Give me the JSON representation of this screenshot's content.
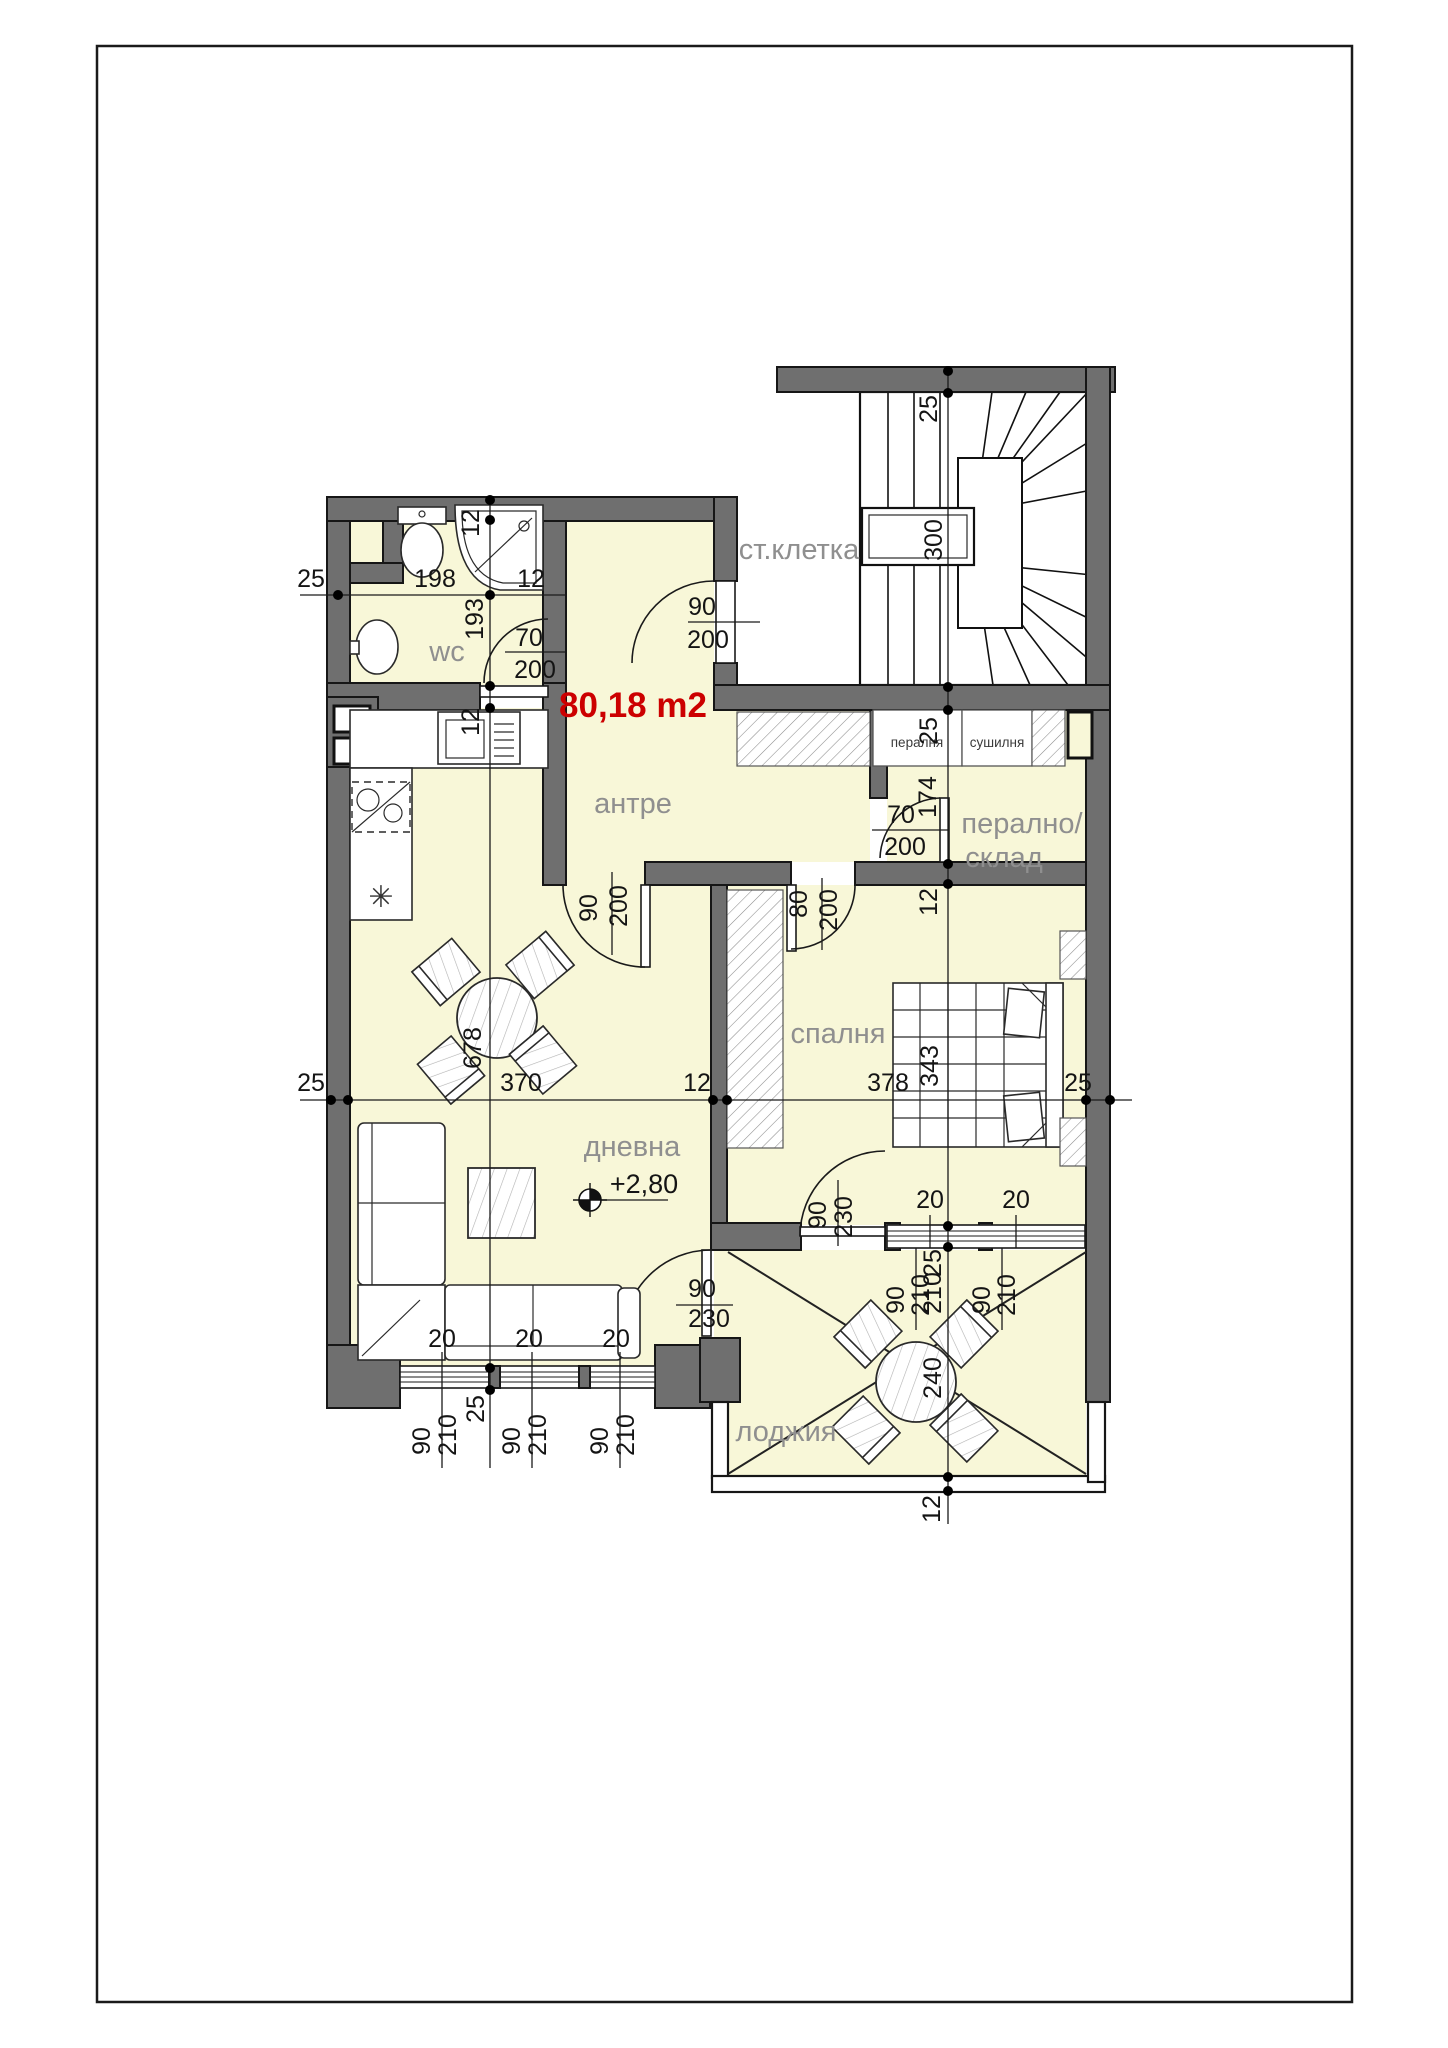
{
  "floor_plan": {
    "area": "80,18 m2",
    "level": "+2,80",
    "rooms": [
      "ст.клетка",
      "wc",
      "антре",
      "дневна",
      "спалня",
      "лоджия",
      "перално/склад",
      "пералня",
      "сушилня"
    ],
    "labels": [
      {
        "t": "ст.клетка",
        "x": 799,
        "y": 559,
        "c": "room",
        "r": 0,
        "n": "label-staircase"
      },
      {
        "t": "wc",
        "x": 447,
        "y": 661,
        "c": "room",
        "r": 0,
        "n": "label-wc"
      },
      {
        "t": "антре",
        "x": 633,
        "y": 813,
        "c": "room",
        "r": 0,
        "n": "label-hallway"
      },
      {
        "t": "дневна",
        "x": 632,
        "y": 1156,
        "c": "room",
        "r": 0,
        "n": "label-living-room"
      },
      {
        "t": "спалня",
        "x": 838,
        "y": 1043,
        "c": "room",
        "r": 0,
        "n": "label-bedroom"
      },
      {
        "t": "лоджия",
        "x": 786,
        "y": 1441,
        "c": "room",
        "r": 0,
        "n": "label-loggia"
      },
      {
        "t": "перално/",
        "x": 1022,
        "y": 833,
        "c": "room",
        "r": 0,
        "n": "label-laundry-line1"
      },
      {
        "t": "склад",
        "x": 1004,
        "y": 867,
        "c": "room",
        "r": 0,
        "n": "label-laundry-line2"
      },
      {
        "t": "пералня",
        "x": 917,
        "y": 747,
        "c": "small",
        "r": 0,
        "n": "label-washer"
      },
      {
        "t": "сушилня",
        "x": 997,
        "y": 747,
        "c": "small",
        "r": 0,
        "n": "label-dryer"
      },
      {
        "t": "80,18 m2",
        "x": 633,
        "y": 717,
        "c": "red",
        "r": 0,
        "n": "label-total-area"
      },
      {
        "t": "+2,80",
        "x": 644,
        "y": 1193,
        "c": "level",
        "r": 0,
        "n": "label-level-mark"
      },
      {
        "t": "✳",
        "x": 381,
        "y": 907,
        "c": "sym",
        "r": 0,
        "n": "fridge-symbol"
      },
      {
        "t": "25",
        "x": 311,
        "y": 587,
        "c": "dim",
        "r": 0,
        "n": "dim"
      },
      {
        "t": "198",
        "x": 435,
        "y": 587,
        "c": "dim",
        "r": 0,
        "n": "dim"
      },
      {
        "t": "12",
        "x": 531,
        "y": 587,
        "c": "dim",
        "r": 0,
        "n": "dim"
      },
      {
        "t": "70",
        "x": 529,
        "y": 646,
        "c": "dim",
        "r": 0,
        "n": "dim-door-wc-width"
      },
      {
        "t": "200",
        "x": 535,
        "y": 678,
        "c": "dim",
        "r": 0,
        "n": "dim-door-wc-height"
      },
      {
        "t": "90",
        "x": 702,
        "y": 615,
        "c": "dim",
        "r": 0,
        "n": "dim-door-entry-width"
      },
      {
        "t": "200",
        "x": 708,
        "y": 648,
        "c": "dim",
        "r": 0,
        "n": "dim-door-entry-height"
      },
      {
        "t": "70",
        "x": 901,
        "y": 823,
        "c": "dim",
        "r": 0,
        "n": "dim-door-laundry-width"
      },
      {
        "t": "200",
        "x": 905,
        "y": 855,
        "c": "dim",
        "r": 0,
        "n": "dim-door-laundry-height"
      },
      {
        "t": "25",
        "x": 311,
        "y": 1091,
        "c": "dim",
        "r": 0,
        "n": "dim"
      },
      {
        "t": "370",
        "x": 521,
        "y": 1091,
        "c": "dim",
        "r": 0,
        "n": "dim"
      },
      {
        "t": "12",
        "x": 697,
        "y": 1091,
        "c": "dim",
        "r": 0,
        "n": "dim"
      },
      {
        "t": "378",
        "x": 888,
        "y": 1091,
        "c": "dim",
        "r": 0,
        "n": "dim"
      },
      {
        "t": "25",
        "x": 1078,
        "y": 1091,
        "c": "dim",
        "r": 0,
        "n": "dim"
      },
      {
        "t": "90",
        "x": 702,
        "y": 1297,
        "c": "dim",
        "r": 0,
        "n": "dim-door-loggia-width"
      },
      {
        "t": "230",
        "x": 709,
        "y": 1327,
        "c": "dim",
        "r": 0,
        "n": "dim-door-loggia-height"
      },
      {
        "t": "20",
        "x": 930,
        "y": 1208,
        "c": "dim",
        "r": 0,
        "n": "dim"
      },
      {
        "t": "20",
        "x": 1016,
        "y": 1208,
        "c": "dim",
        "r": 0,
        "n": "dim"
      },
      {
        "t": "20",
        "x": 442,
        "y": 1347,
        "c": "dim",
        "r": 0,
        "n": "dim"
      },
      {
        "t": "20",
        "x": 529,
        "y": 1347,
        "c": "dim",
        "r": 0,
        "n": "dim"
      },
      {
        "t": "20",
        "x": 616,
        "y": 1347,
        "c": "dim",
        "r": 0,
        "n": "dim"
      },
      {
        "t": "12",
        "x": 479,
        "y": 523,
        "c": "dim",
        "r": 1,
        "n": "dim"
      },
      {
        "t": "193",
        "x": 483,
        "y": 619,
        "c": "dim",
        "r": 1,
        "n": "dim"
      },
      {
        "t": "12",
        "x": 479,
        "y": 722,
        "c": "dim",
        "r": 1,
        "n": "dim"
      },
      {
        "t": "25",
        "x": 484,
        "y": 1409,
        "c": "dim",
        "r": 1,
        "n": "dim"
      },
      {
        "t": "25",
        "x": 937,
        "y": 409,
        "c": "dim",
        "r": 1,
        "n": "dim"
      },
      {
        "t": "300",
        "x": 942,
        "y": 540,
        "c": "dim",
        "r": 1,
        "n": "dim-stair-width"
      },
      {
        "t": "25",
        "x": 937,
        "y": 731,
        "c": "dim",
        "r": 1,
        "n": "dim"
      },
      {
        "t": "174",
        "x": 936,
        "y": 797,
        "c": "dim",
        "r": 1,
        "n": "dim"
      },
      {
        "t": "12",
        "x": 937,
        "y": 902,
        "c": "dim",
        "r": 1,
        "n": "dim"
      },
      {
        "t": "343",
        "x": 938,
        "y": 1066,
        "c": "dim",
        "r": 1,
        "n": "dim"
      },
      {
        "t": "25",
        "x": 941,
        "y": 1263,
        "c": "dim",
        "r": 1,
        "n": "dim"
      },
      {
        "t": "210",
        "x": 941,
        "y": 1293,
        "c": "dim",
        "r": 1,
        "n": "dim"
      },
      {
        "t": "240",
        "x": 941,
        "y": 1378,
        "c": "dim",
        "r": 1,
        "n": "dim"
      },
      {
        "t": "12",
        "x": 940,
        "y": 1509,
        "c": "dim",
        "r": 1,
        "n": "dim"
      },
      {
        "t": "90",
        "x": 597,
        "y": 908,
        "c": "dim",
        "r": 1,
        "n": "dim-door-living-width"
      },
      {
        "t": "200",
        "x": 627,
        "y": 906,
        "c": "dim",
        "r": 1,
        "n": "dim-door-living-height"
      },
      {
        "t": "80",
        "x": 807,
        "y": 904,
        "c": "dim",
        "r": 1,
        "n": "dim-door-bedroom-width"
      },
      {
        "t": "200",
        "x": 837,
        "y": 910,
        "c": "dim",
        "r": 1,
        "n": "dim-door-bedroom-height"
      },
      {
        "t": "678",
        "x": 481,
        "y": 1048,
        "c": "dim",
        "r": 1,
        "n": "dim-living-length"
      },
      {
        "t": "90",
        "x": 826,
        "y": 1215,
        "c": "dim",
        "r": 1,
        "n": "dim-door-bedroom-loggia-width"
      },
      {
        "t": "230",
        "x": 852,
        "y": 1217,
        "c": "dim",
        "r": 1,
        "n": "dim-door-bedroom-loggia-height"
      },
      {
        "t": "90",
        "x": 904,
        "y": 1300,
        "c": "dim",
        "r": 1,
        "n": "dim-window"
      },
      {
        "t": "210",
        "x": 929,
        "y": 1295,
        "c": "dim",
        "r": 1,
        "n": "dim-window"
      },
      {
        "t": "90",
        "x": 990,
        "y": 1300,
        "c": "dim",
        "r": 1,
        "n": "dim-window"
      },
      {
        "t": "210",
        "x": 1015,
        "y": 1295,
        "c": "dim",
        "r": 1,
        "n": "dim-window"
      },
      {
        "t": "90",
        "x": 430,
        "y": 1441,
        "c": "dim",
        "r": 1,
        "n": "dim-window"
      },
      {
        "t": "210",
        "x": 456,
        "y": 1435,
        "c": "dim",
        "r": 1,
        "n": "dim-window"
      },
      {
        "t": "90",
        "x": 520,
        "y": 1441,
        "c": "dim",
        "r": 1,
        "n": "dim-window"
      },
      {
        "t": "210",
        "x": 546,
        "y": 1435,
        "c": "dim",
        "r": 1,
        "n": "dim-window"
      },
      {
        "t": "90",
        "x": 608,
        "y": 1441,
        "c": "dim",
        "r": 1,
        "n": "dim-window"
      },
      {
        "t": "210",
        "x": 634,
        "y": 1435,
        "c": "dim",
        "r": 1,
        "n": "dim-window"
      }
    ]
  }
}
